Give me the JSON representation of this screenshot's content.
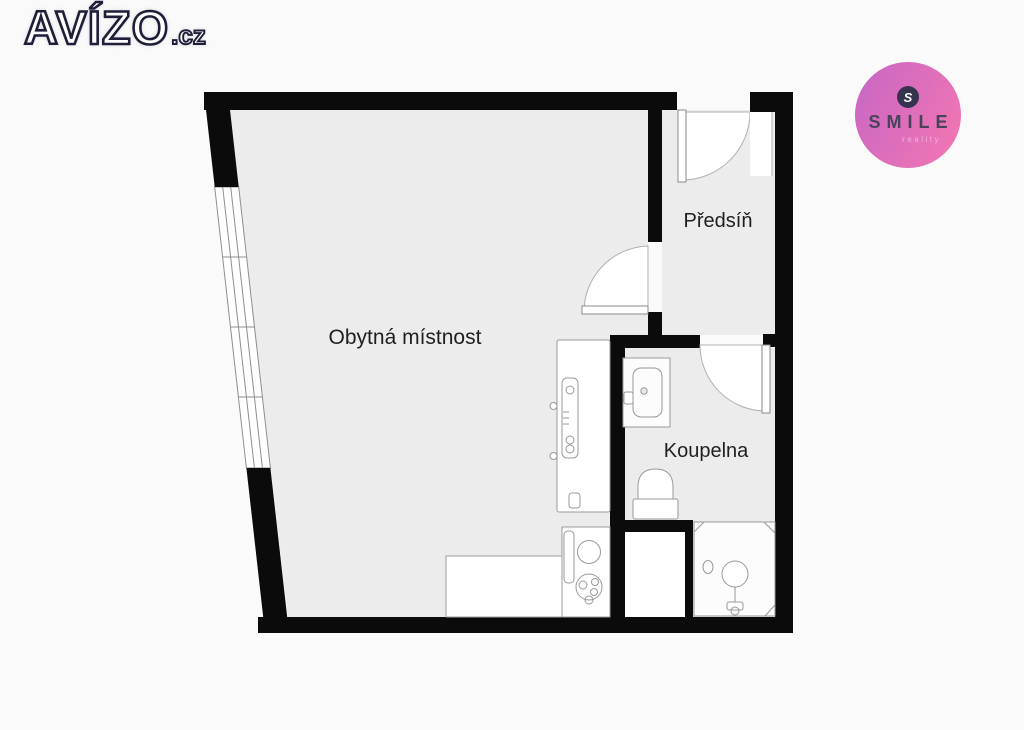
{
  "page": {
    "background": "#fafafa"
  },
  "brand": {
    "name": "AVÍZO",
    "tld": ".cz"
  },
  "agency": {
    "name": "SMILE",
    "tagline": "reality",
    "initial": "S",
    "colors": {
      "circle_start": "#cb68c3",
      "circle_end": "#ee74b4",
      "text": "#474359",
      "tagline_color": "#f2b3d8",
      "icon_bg": "#35334e"
    }
  },
  "floorplan": {
    "rooms": [
      {
        "id": "living-room",
        "label": "Obytná místnost"
      },
      {
        "id": "hallway",
        "label": "Předsíň"
      },
      {
        "id": "bathroom",
        "label": "Koupelna"
      }
    ],
    "colors": {
      "wall": "#0b0b0b",
      "floor": "#ececec",
      "fixture_line": "#999999",
      "door_line": "#b0b0b0",
      "label_text": "#1f1f1f"
    }
  }
}
